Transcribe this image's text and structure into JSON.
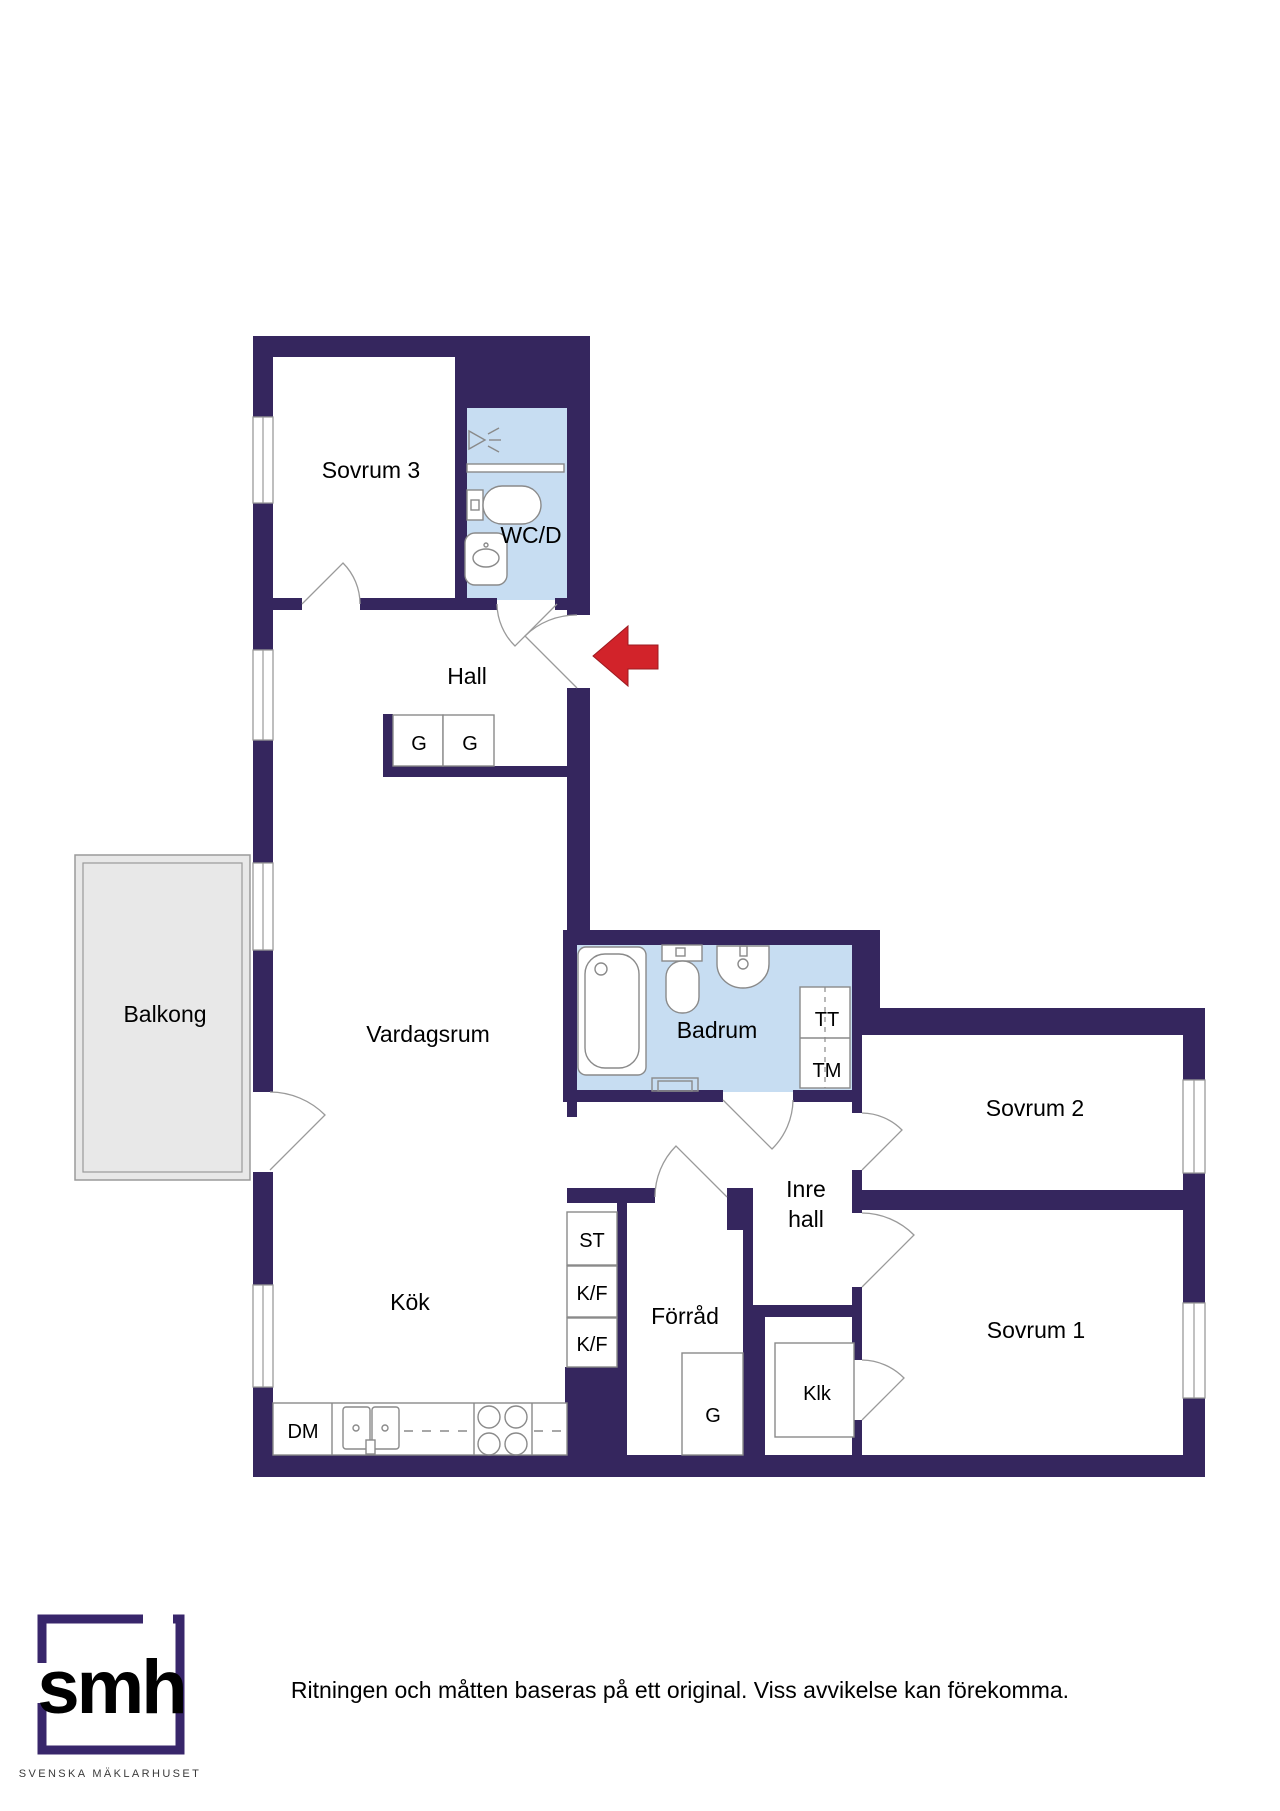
{
  "colors": {
    "wall": "#35265e",
    "wetroom": "#c7ddf2",
    "balcony": "#e8e8e8",
    "arrow": "#d2232a",
    "logo": "#38266b"
  },
  "labels": {
    "sovrum3": "Sovrum 3",
    "wcd": "WC/D",
    "hall": "Hall",
    "wardrobe_hall_1": "G",
    "wardrobe_hall_2": "G",
    "balkong": "Balkong",
    "vardagsrum": "Vardagsrum",
    "badrum": "Badrum",
    "tt": "TT",
    "tm": "TM",
    "sovrum2": "Sovrum 2",
    "inre_hall_line1": "Inre",
    "inre_hall_line2": "hall",
    "st": "ST",
    "kf_upper": "K/F",
    "kf_lower": "K/F",
    "forrad": "Förråd",
    "kok": "Kök",
    "wardrobe_forrad": "G",
    "klk": "Klk",
    "sovrum1": "Sovrum 1",
    "dm": "DM"
  },
  "footer": {
    "disclaimer": "Ritningen och måtten baseras på ett original. Viss avvikelse kan förekomma.",
    "logo_text": "smh",
    "logo_subtext": "SVENSKA MÄKLARHUSET"
  }
}
